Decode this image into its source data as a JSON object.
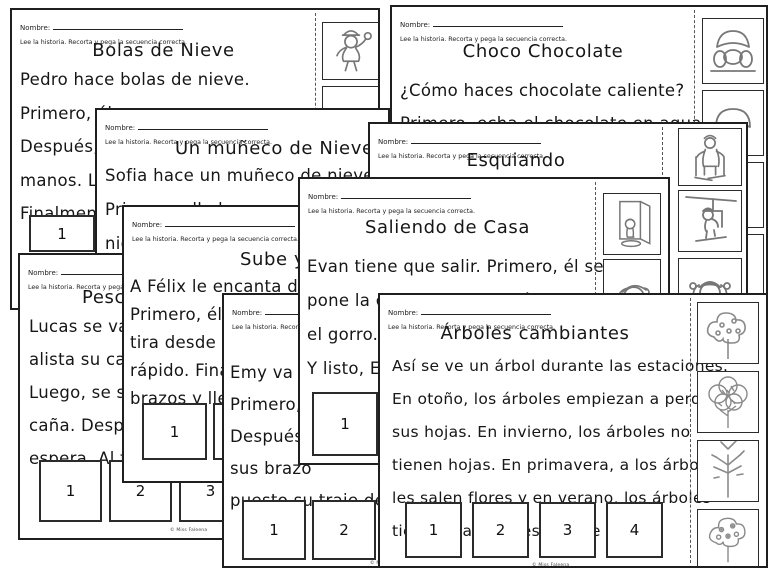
{
  "shared": {
    "nombre_label": "Nombre:",
    "instruction": "Lee la historia. Recorta y pega la secuencia correcta.",
    "watermark": "© Miss Faleena"
  },
  "accent_colors": {
    "paper": "#ffffff",
    "ink": "#1f1f1f",
    "clipart_stroke": "#777777"
  },
  "pages": {
    "bolas": {
      "title": "Bolas de Nieve",
      "lines": [
        "Pedro hace bolas de nieve.",
        "Primero, él",
        "Después, la",
        "manos. Lueg",
        "Finalmente"
      ],
      "boxes": [
        "1",
        "2",
        "3",
        "4"
      ],
      "images": [
        "kid-throwing-snowball",
        "kid-with-winter-hat"
      ]
    },
    "choco": {
      "title": "Choco Chocolate",
      "lines": [
        "¿Cómo haces chocolate caliente?",
        "Primero, echa el chocolate en agua"
      ],
      "boxes": [],
      "images": [
        "kid-drinking-hot-chocolate",
        "kid-face",
        "kid-standing",
        "kid-standing"
      ]
    },
    "muneco": {
      "title": "Un muñeco de Nieve",
      "lines": [
        "Sofia hace un muñeco de nieve.",
        "Primero, ella hace una bola",
        "nieve."
      ],
      "boxes": [],
      "images": []
    },
    "esquiando": {
      "title": "Esquiando",
      "lines": [],
      "boxes": [],
      "images": [
        "skier-with-poles",
        "kid-on-ski-lift",
        "kid-raising-arms"
      ]
    },
    "pes": {
      "title": "Pescando",
      "lines": [
        "Lucas se va a",
        "alista su caña",
        "Luego, se sient",
        "caña. Después",
        "espera. Al fina"
      ],
      "boxes": [
        "1",
        "2",
        "3",
        "4"
      ],
      "images": []
    },
    "sube": {
      "title": "Sube y Baja",
      "lines": [
        "A Félix le encanta desliza",
        "Primero, él se",
        "tira desde arri",
        "rápido. Finalm",
        "brazos y llega"
      ],
      "boxes": [
        "1",
        "2",
        "3",
        "4"
      ],
      "images": []
    },
    "emy": {
      "lines": [
        "Emy va a e",
        "Primero, e",
        "Después, s",
        "sus brazo",
        "puesto su traje de n"
      ],
      "boxes": [
        "1",
        "2",
        "3",
        "4"
      ],
      "images": []
    },
    "saliendo": {
      "title": "Saliendo de Casa",
      "lines": [
        "Evan tiene que salir. Primero, él se",
        "pone la chaqueta. Después, se pone",
        "el gorro. Luego se pone los",
        "Y listo, Evan"
      ],
      "boxes": [
        "1",
        "2"
      ],
      "images": [
        "kid-at-open-door",
        "kid-putting-on-hat"
      ]
    },
    "arboles": {
      "title": "Árboles cambiantes",
      "lines": [
        "Así se ve un árbol durante las estaciones.",
        "En otoño, los árboles empiezan a perder",
        "sus hojas. En invierno, los árboles no",
        "tienen hojas. En primavera, a los árboles",
        "les salen flores y en verano, los árboles",
        "tiene hojas verdes y tiene frutos."
      ],
      "boxes": [
        "1",
        "2",
        "3",
        "4"
      ],
      "images": [
        "tree-with-fruits",
        "tree-with-leaves",
        "bare-tree",
        "tree-with-flowers"
      ]
    }
  }
}
